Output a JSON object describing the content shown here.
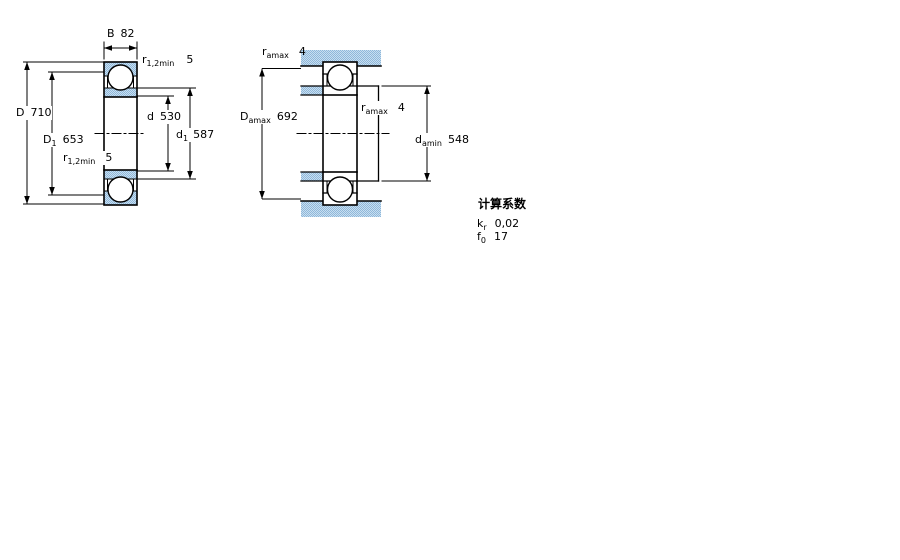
{
  "colors": {
    "line": "#000000",
    "hatch_light": "#c8dff0",
    "hatch_dark": "#8fb7da",
    "background": "#ffffff"
  },
  "left_figure": {
    "description": "bearing cross-section",
    "dims": {
      "B": {
        "symbol": "B",
        "sub": "",
        "value": "82"
      },
      "r_top": {
        "symbol": "r",
        "sub": "1,2min",
        "value": "5"
      },
      "D": {
        "symbol": "D",
        "sub": "",
        "value": "710"
      },
      "D1": {
        "symbol": "D",
        "sub": "1",
        "value": "653"
      },
      "r_bottom": {
        "symbol": "r",
        "sub": "1,2min",
        "value": "5"
      },
      "d": {
        "symbol": "d",
        "sub": "",
        "value": "530"
      },
      "d1": {
        "symbol": "d",
        "sub": "1",
        "value": "587"
      }
    }
  },
  "right_figure": {
    "description": "mounting dimensions",
    "dims": {
      "ra_top": {
        "symbol": "r",
        "sub": "amax",
        "value": "4"
      },
      "Damax": {
        "symbol": "D",
        "sub": "amax",
        "value": "692"
      },
      "ra_mid": {
        "symbol": "r",
        "sub": "amax",
        "value": "4"
      },
      "damin": {
        "symbol": "d",
        "sub": "amin",
        "value": "548"
      }
    }
  },
  "calculation_factors": {
    "title": "计算系数",
    "rows": [
      {
        "symbol": "k",
        "sub": "r",
        "value": "0,02"
      },
      {
        "symbol": "f",
        "sub": "0",
        "value": "17"
      }
    ]
  }
}
